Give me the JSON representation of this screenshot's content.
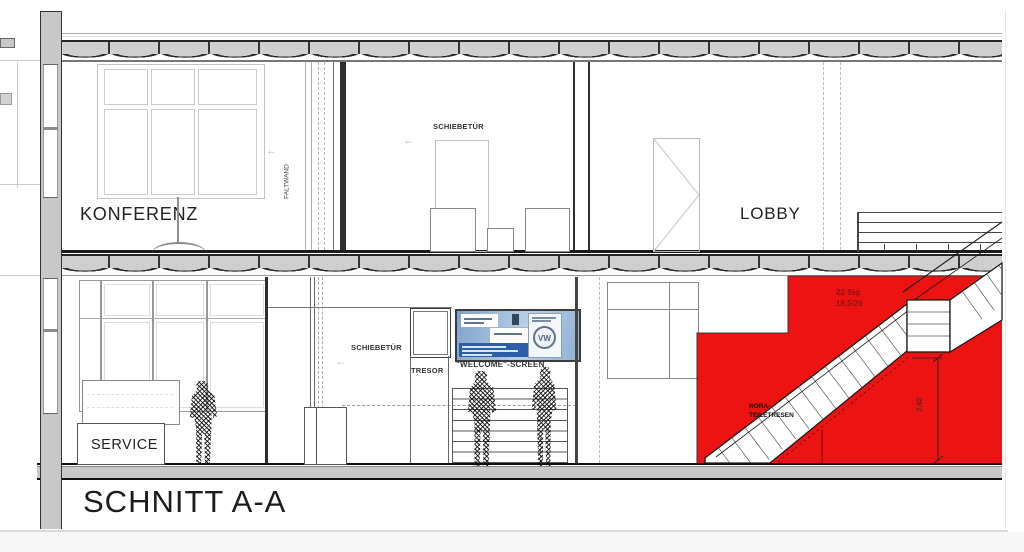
{
  "sheet": {
    "title": "SCHNITT A-A"
  },
  "rooms": {
    "konferenz": "KONFERENZ",
    "lobby": "LOBBY",
    "service": "SERVICE"
  },
  "labels": {
    "schiebetuer_upper": "SCHIEBETÜR",
    "faltwand": "FALTWAND",
    "schiebetuer_lower": "SCHIEBETÜR",
    "tresor": "TRESOR",
    "welcome_screen": "\"WELCOME\"-SCREEN",
    "nora_line1": "NORA-",
    "nora_line2": "TEILETRESEN"
  },
  "stair": {
    "steps": "22 Stg",
    "ratio": "18,5/26",
    "height_dim": "2,62"
  },
  "icons": {
    "vw_logo": "VW",
    "arrow_left": "←"
  },
  "colors": {
    "highlight_red": "#ee1313",
    "deck_gray": "#cfcfcf",
    "screen_blue": "#2b5ea7"
  }
}
